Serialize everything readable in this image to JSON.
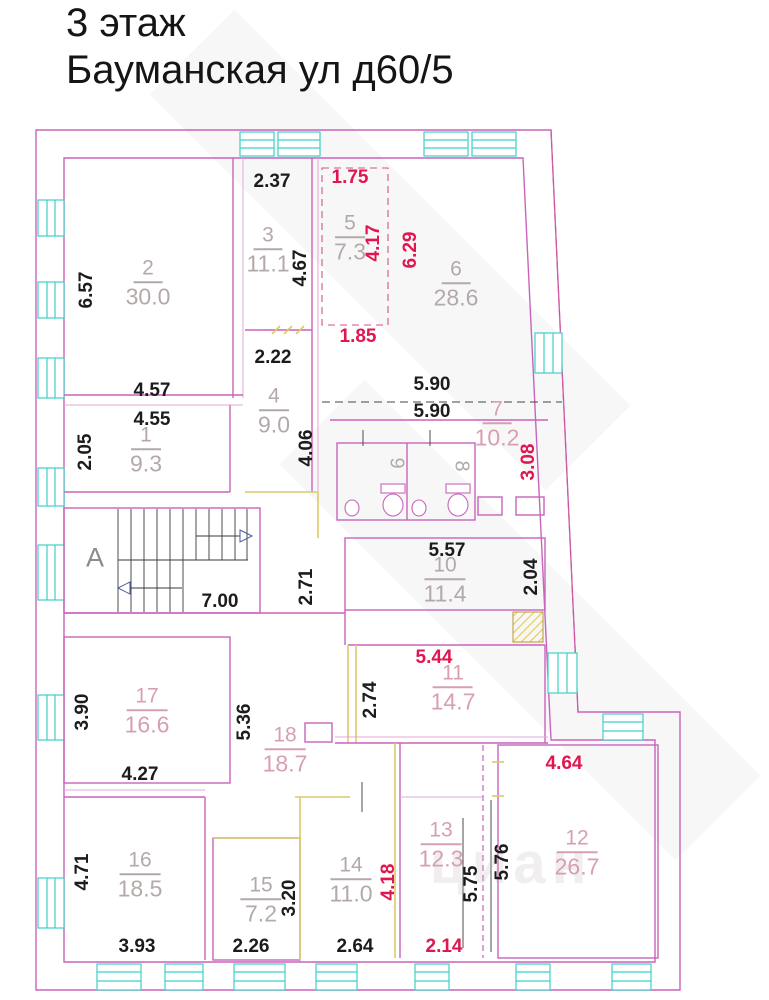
{
  "title": {
    "line1": "3 этаж",
    "line2": "Бауманская ул д60/5"
  },
  "watermark": "циан",
  "stairwell": {
    "letter": "А"
  },
  "colors": {
    "wall_magenta": "#c864bc",
    "wall_yellow": "#dcc96a",
    "window_cyan": "#3fd0c8",
    "dim_black": "#1c1c1c",
    "dim_red": "#e0164f",
    "room_label_gray": "#b4a9a9",
    "room_label_pink": "#d79fb2"
  },
  "rooms": {
    "r1": {
      "num": "1",
      "area": "9.3"
    },
    "r2": {
      "num": "2",
      "area": "30.0"
    },
    "r3": {
      "num": "3",
      "area": "11.1"
    },
    "r4": {
      "num": "4",
      "area": "9.0"
    },
    "r5": {
      "num": "5",
      "area": "7.3"
    },
    "r6": {
      "num": "6",
      "area": "28.6"
    },
    "r7": {
      "num": "7",
      "area": "10.2"
    },
    "r8": {
      "num": "8"
    },
    "r9": {
      "num": "9"
    },
    "r10": {
      "num": "10",
      "area": "11.4"
    },
    "r11": {
      "num": "11",
      "area": "14.7"
    },
    "r12": {
      "num": "12",
      "area": "26.7"
    },
    "r13": {
      "num": "13",
      "area": "12.3"
    },
    "r14": {
      "num": "14",
      "area": "11.0"
    },
    "r15": {
      "num": "15",
      "area": "7.2"
    },
    "r16": {
      "num": "16",
      "area": "18.5"
    },
    "r17": {
      "num": "17",
      "area": "16.6"
    },
    "r18": {
      "num": "18",
      "area": "18.7"
    }
  },
  "dims_black": {
    "room2_left": "6.57",
    "room3_top": "2.37",
    "room3_right": "4.67",
    "room2_bottom": "4.57",
    "room1_top": "4.55",
    "room1_left": "2.05",
    "room4_top": "2.22",
    "room4_right": "4.06",
    "corridor_590_upper": "5.90",
    "corridor_590_lower": "5.90",
    "room10_top": "5.57",
    "room10_right": "2.04",
    "stair_bottom": "7.00",
    "corridor_right_of_stairs": "2.71",
    "room11_left": "2.74",
    "room17_left": "3.90",
    "corridor18_left": "5.36",
    "room17_bottom": "4.27",
    "room16_left": "4.71",
    "room15_right": "3.20",
    "room16_bottom": "3.93",
    "room15_bottom": "2.26",
    "room14_bottom": "2.64",
    "room13_right_inner": "5.75",
    "room13_right_outer": "5.76"
  },
  "dims_red": {
    "room5_top": "1.75",
    "room5_right": "4.17",
    "room6_left": "6.29",
    "room5_bottom": "1.85",
    "wall_right": "3.08",
    "room11_top": "5.44",
    "room12_top": "4.64",
    "room14_right": "4.18",
    "room13_bottom": "2.14"
  }
}
